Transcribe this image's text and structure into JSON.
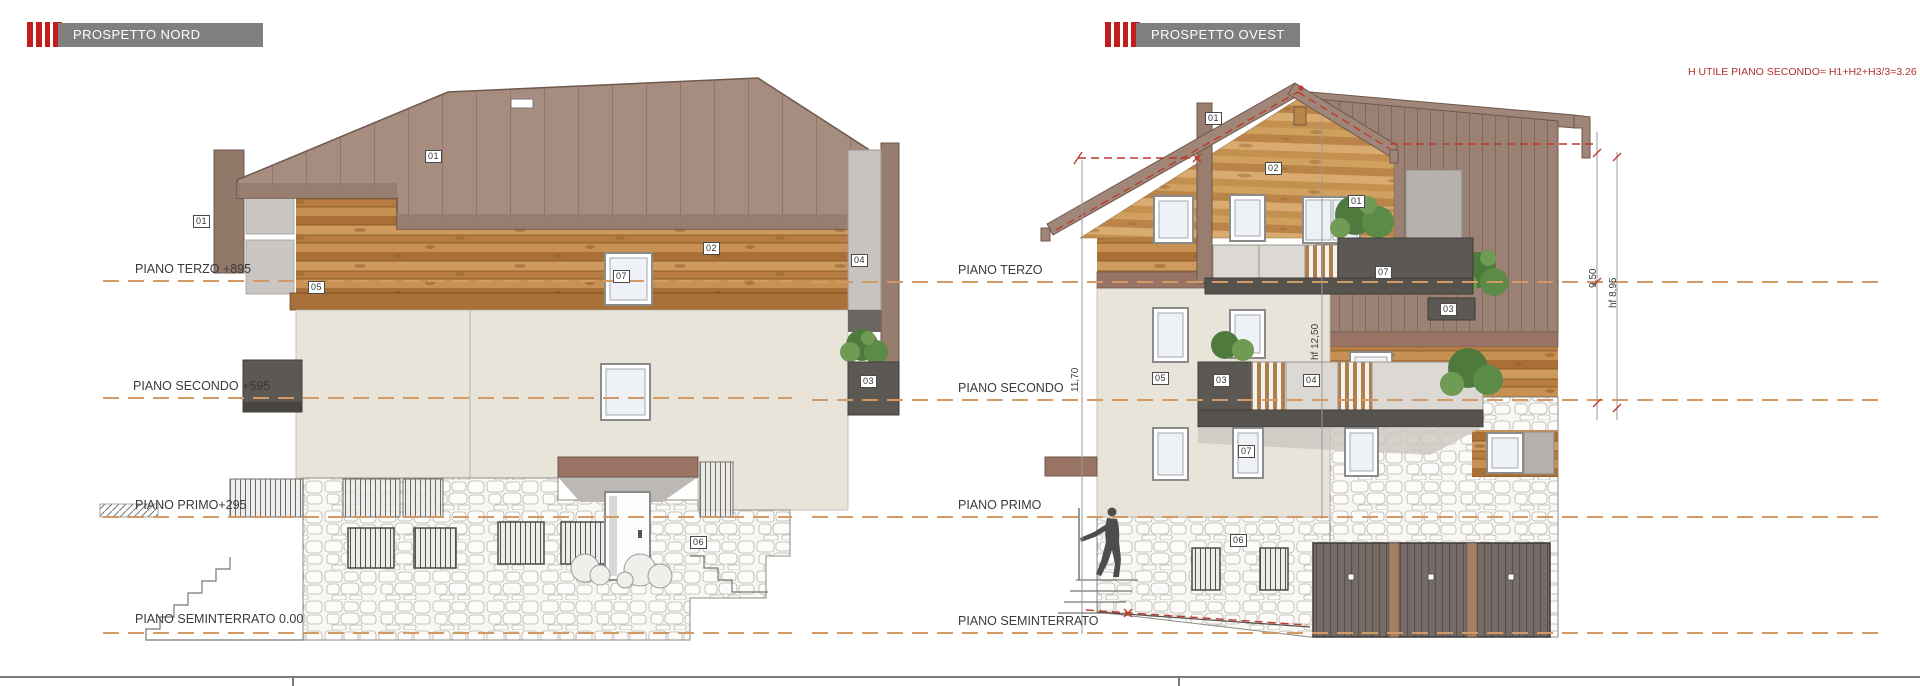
{
  "headers": {
    "nord": "PROSPETTO NORD",
    "ovest": "PROSPETTO OVEST"
  },
  "nord_levels": [
    "PIANO TERZO +895",
    "PIANO SECONDO +595",
    "PIANO PRIMO+295",
    "PIANO SEMINTERRATO 0.00"
  ],
  "ovest_levels": [
    "PIANO TERZO",
    "PIANO SECONDO",
    "PIANO PRIMO",
    "PIANO SEMINTERRATO"
  ],
  "annotation": "H UTILE PIANO SECONDO= H1+H2+H3/3=3.26",
  "dimensions": {
    "height_total": "11,70",
    "height_hf1250": "hf 12,50",
    "height_950": "9,50",
    "height_hf895": "hf 8,95"
  },
  "tags": {
    "t01": "01",
    "t02": "02",
    "t03": "03",
    "t04": "04",
    "t05": "05",
    "t06": "06",
    "t07": "07"
  },
  "colors": {
    "header_bar": "#7f7f7f",
    "brand_red": "#c21d1d",
    "roof": "#a68d80",
    "wood": "#c08548",
    "wall": "#e9e4da",
    "dark_panel": "#5c5854",
    "level_line": "#d39a66",
    "annotation_red": "#b03030"
  }
}
